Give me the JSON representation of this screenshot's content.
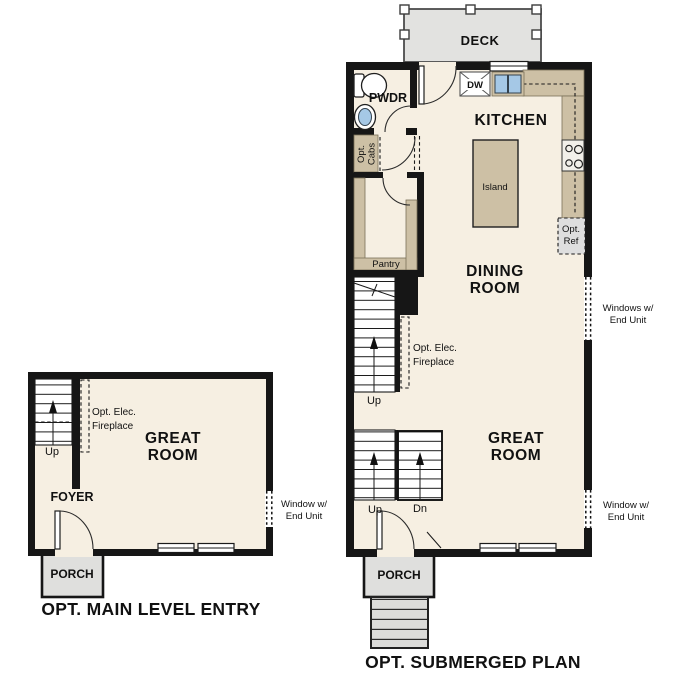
{
  "colors": {
    "floor": "#F6EFE2",
    "counter": "#CDC0A5",
    "deck": "#E2E2E0",
    "porch": "#DFDFDD",
    "ref": "#DEDEDE",
    "sink": "#A5C8E6",
    "wall": "#161616",
    "text": "#111111"
  },
  "left_plan": {
    "title": "OPT. MAIN LEVEL ENTRY",
    "labels": {
      "great_room": [
        "GREAT",
        "ROOM"
      ],
      "foyer": "FOYER",
      "porch": "PORCH",
      "up": "Up",
      "fireplace": [
        "Opt. Elec.",
        "Fireplace"
      ],
      "window_note": [
        "Window w/",
        "End Unit"
      ]
    }
  },
  "right_plan": {
    "title": "OPT. SUBMERGED PLAN",
    "labels": {
      "deck": "DECK",
      "pwdr": "PWDR",
      "dw": "DW",
      "kitchen": "KITCHEN",
      "island": "Island",
      "opt_cabs": [
        "Opt.",
        "Cabs"
      ],
      "pantry": "Pantry",
      "dining_room": [
        "DINING",
        "ROOM"
      ],
      "opt_ref": [
        "Opt.",
        "Ref"
      ],
      "windows_note": [
        "Windows w/",
        "End Unit"
      ],
      "fireplace": [
        "Opt. Elec.",
        "Fireplace"
      ],
      "stair_up": "Up",
      "great_room": [
        "GREAT",
        "ROOM"
      ],
      "entry_up": "Up",
      "entry_dn": "Dn",
      "window_note": [
        "Window w/",
        "End Unit"
      ],
      "porch": "PORCH"
    }
  }
}
